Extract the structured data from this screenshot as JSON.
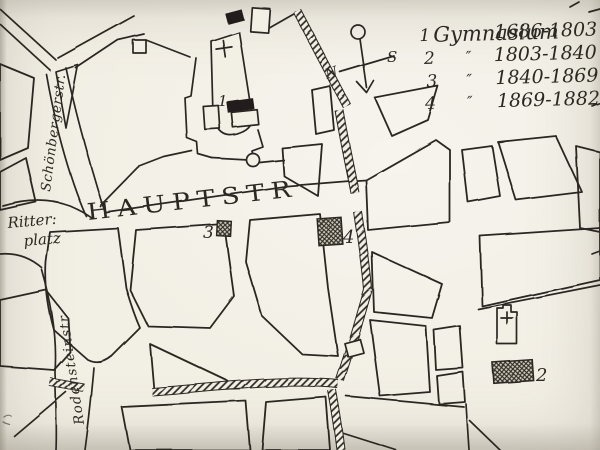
{
  "legend": {
    "rows": [
      {
        "num": "1",
        "name": "Gymnasium",
        "dates": "1686-1803"
      },
      {
        "num": "2",
        "name": "″",
        "dates": "1803-1840"
      },
      {
        "num": "3",
        "name": "″",
        "dates": "1840-1869"
      },
      {
        "num": "4",
        "name": "″",
        "dates": "1869-1882"
      }
    ]
  },
  "compass": {
    "north": "N",
    "south": "S"
  },
  "labels": {
    "hauptstr": "HAUPTSTR",
    "schoenbergerstr": "Schönbergerstr.",
    "ritterplatz_line1": "Ritter:",
    "ritterplatz_line2": "platz",
    "rodensteinstr": "Rodensteinstr"
  },
  "markers": {
    "m1": "1",
    "m2": "2",
    "m3": "3",
    "m4": "4"
  },
  "colors": {
    "paper": "#f2efe5",
    "ink": "#2b2822"
  }
}
